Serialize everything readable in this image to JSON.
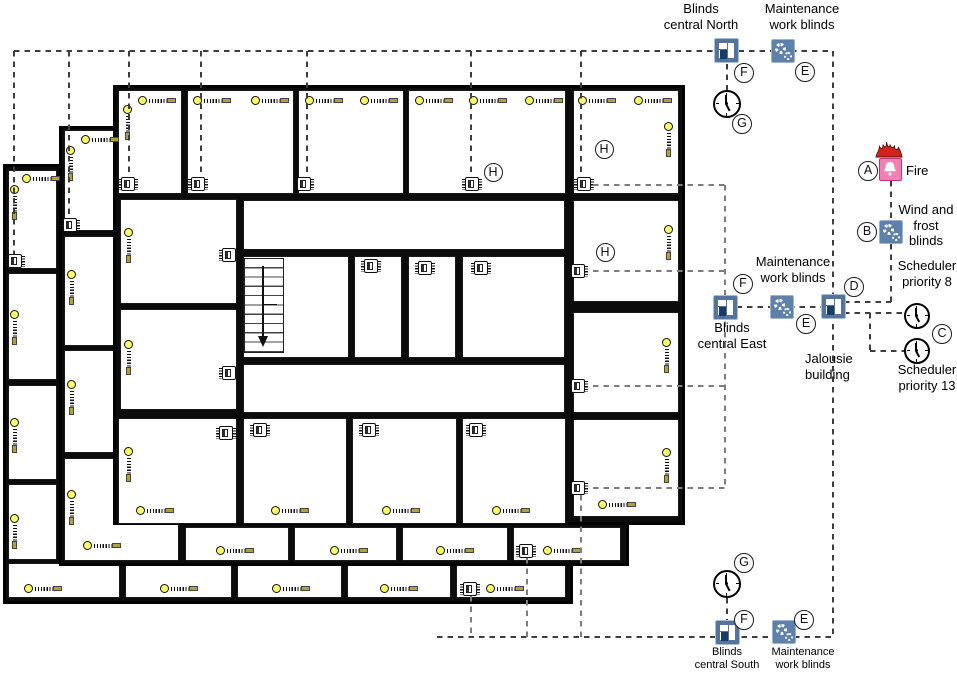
{
  "letters": {
    "a": "A",
    "b": "B",
    "c": "C",
    "d": "D",
    "e": "E",
    "f": "F",
    "g": "G",
    "h": "H"
  },
  "labels": {
    "blinds_north": [
      "Blinds",
      "central North"
    ],
    "maintenance_north": [
      "Maintenance",
      "work blinds"
    ],
    "fire": "Fire",
    "wind_frost": [
      "Wind and",
      "frost",
      "blinds"
    ],
    "scheduler8": [
      "Scheduler",
      "priority 8"
    ],
    "scheduler13": [
      "Scheduler",
      "priority 13"
    ],
    "jalousie": [
      "Jalousie",
      "building"
    ],
    "maintenance_east": [
      "Maintenance",
      "work blinds"
    ],
    "blinds_east": [
      "Blinds",
      "central East"
    ],
    "blinds_south": [
      "Blinds",
      "central South"
    ],
    "maintenance_south": [
      "Maintenance",
      "work blinds"
    ]
  },
  "icons": {
    "blinds_group": "window-blinds-icon",
    "maintenance": "gear-icon",
    "scheduler": "clock-icon",
    "fire": "fire-bell-icon",
    "wind_frost": "gear-icon",
    "room_blind": "blind-drive-symbol",
    "room_actuator": "window-actuator-icon"
  },
  "colors": {
    "icon_blue": "#54749e",
    "icon_blue_dark": "#1a3a67",
    "gear_blue": "#5e81ac",
    "fire_pink": "#ee83b3",
    "fire_border": "#bf3181",
    "flame_red": "#d0231c",
    "blind_yellow": "#fbfb6a",
    "dash_dark": "#3e3e3e",
    "dash_gray": "#7d7d7d"
  }
}
